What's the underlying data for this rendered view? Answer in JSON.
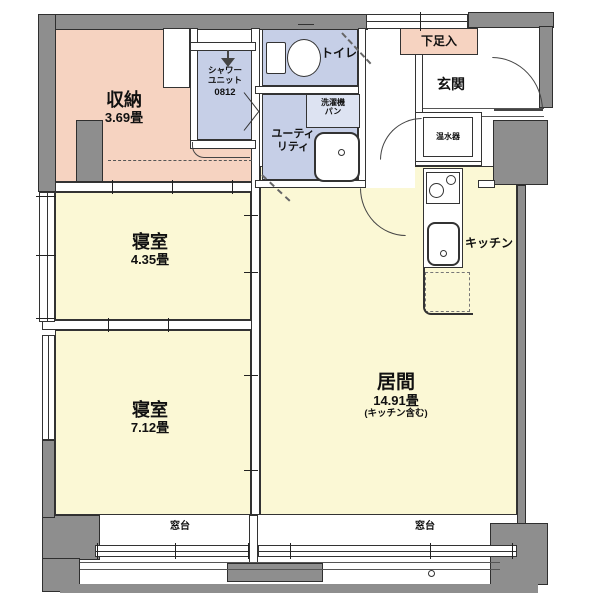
{
  "floorplan": {
    "rooms": {
      "storage": {
        "name": "収納",
        "area": "3.69畳"
      },
      "shower_unit": {
        "line1": "シャワー",
        "line2": "ユニット",
        "model": "0812"
      },
      "toilet": {
        "name": "トイレ"
      },
      "washing_machine_pan": {
        "line1": "洗濯機",
        "line2": "パン"
      },
      "utility": {
        "line1": "ユーティ",
        "line2": "リティ"
      },
      "shoe_box": {
        "name": "下足入"
      },
      "entrance": {
        "name": "玄関"
      },
      "water_heater": {
        "name": "温水器"
      },
      "kitchen": {
        "name": "キッチン"
      },
      "bedroom_small": {
        "name": "寝室",
        "area": "4.35畳"
      },
      "bedroom_large": {
        "name": "寝室",
        "area": "7.12畳"
      },
      "living": {
        "name": "居間",
        "area": "14.91畳",
        "note": "(キッチン含む)"
      },
      "window_sill_left": {
        "name": "窓台"
      },
      "window_sill_right": {
        "name": "窓台"
      }
    },
    "colors": {
      "wall_gray": "#8e8e8e",
      "room_yellow": "#FBF8D5",
      "room_blue": "#C6CFE7",
      "room_salmon": "#F6D3C1",
      "line": "#333333"
    }
  }
}
